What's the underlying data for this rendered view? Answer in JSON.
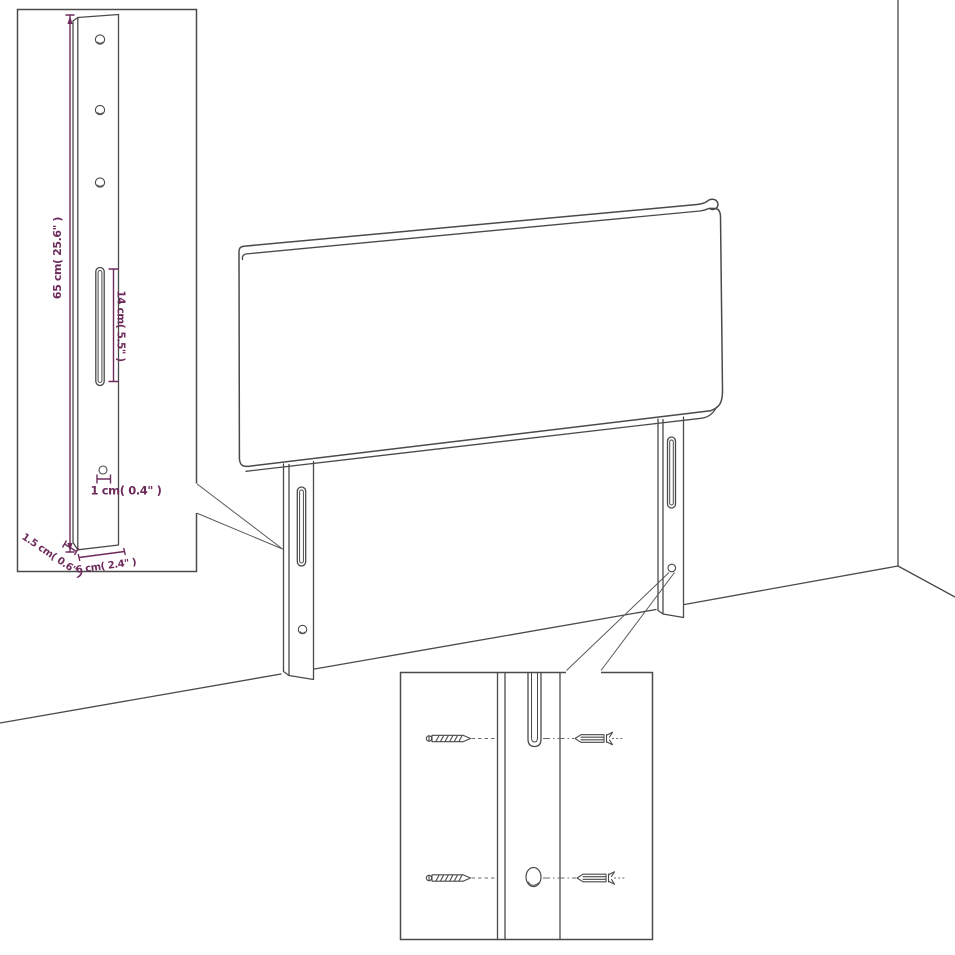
{
  "diagram": {
    "type": "furniture-dimension-diagram",
    "subject": "upholstered headboard with two mounting legs, wall corner backdrop, leg detail inset and wall-mounting hardware inset",
    "colors": {
      "background": "#ffffff",
      "outline": "#4a4a4a",
      "dimension": "#6d2b5b"
    },
    "labels": {
      "leg_height": "65 cm( 25.6\" )",
      "slot_length": "14 cm( 5.5\" )",
      "hole_diameter": "1 cm( 0.4\" )",
      "leg_thickness": "1.5 cm( 0.6\" )",
      "leg_width": "6 cm( 2.4\" )"
    }
  }
}
